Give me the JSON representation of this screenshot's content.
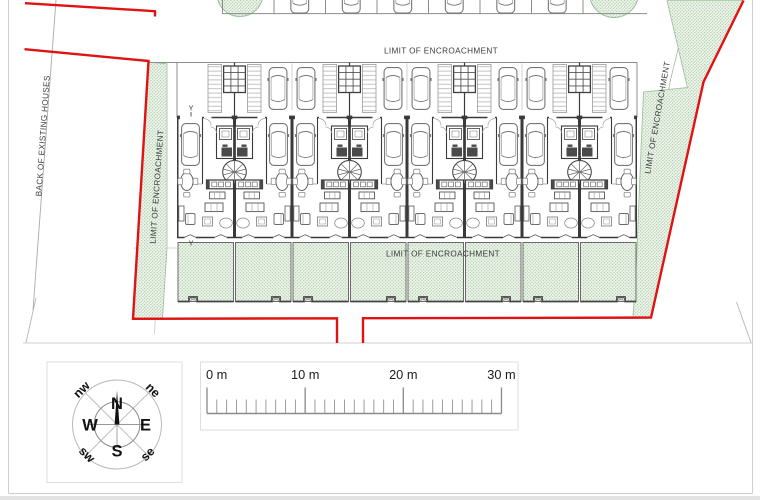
{
  "plan": {
    "labels": {
      "limit_of_encroachment_top": "LIMIT OF ENCROACHMENT",
      "limit_of_encroachment_bottom": "LIMIT OF ENCROACHMENT",
      "limit_of_encroachment_left": "LIMIT OF ENCROACHMENT",
      "limit_of_encroachment_right": "LIMIT OF ENCROACHMENT",
      "back_of_existing_houses": "BACK OF EXISTING HOUSES",
      "section_marker_top": "Y",
      "section_marker_bottom": "Y"
    },
    "site": {
      "house_units": 8,
      "top_parking_cars": 6,
      "top_parking_bay_dividers": 8
    },
    "colors": {
      "boundary_red": "#e01212",
      "green_fill": "#eef4ec",
      "green_dot": "#a3c8a0",
      "wall_dark": "#3a3a3a",
      "line_gray": "#8c8c8c"
    }
  },
  "legend": {
    "compass": {
      "n": "N",
      "e": "E",
      "s": "S",
      "w": "W",
      "nw": "nw",
      "ne": "ne",
      "sw": "sw",
      "se": "se"
    },
    "scale_bar": {
      "labels": [
        "0 m",
        "10 m",
        "20 m",
        "30 m"
      ],
      "minor_ticks_per_major": 10
    }
  }
}
